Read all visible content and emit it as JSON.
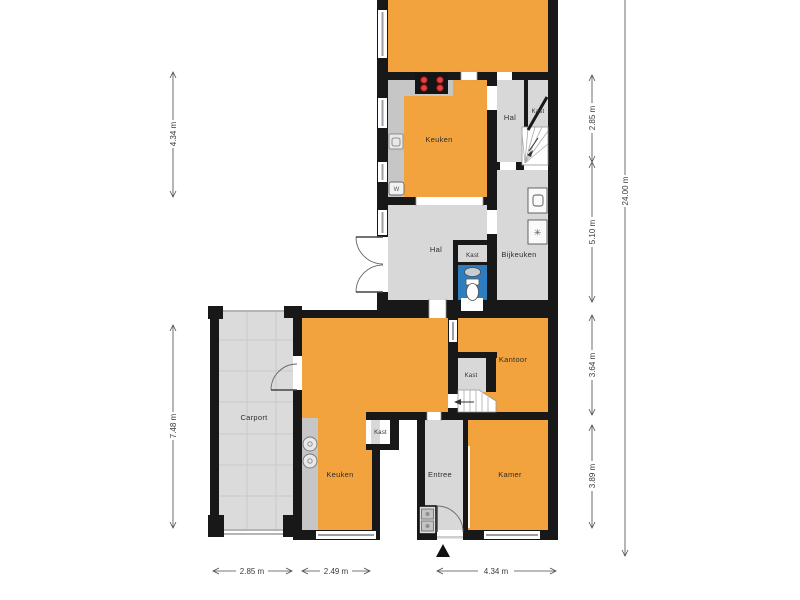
{
  "plan": {
    "type": "floorplan",
    "colors": {
      "room_orange": "#F2A33E",
      "room_gray": "#D8D8D8",
      "counter_gray": "#C6C6C6",
      "carport_gray": "#DBDBDB",
      "wall_black": "#181818",
      "toilet_blue": "#2E7DBF"
    },
    "rooms": {
      "keuken_top": {
        "label": "Keuken"
      },
      "hal_top": {
        "label": "Hal"
      },
      "kast_top": {
        "label": "Kast"
      },
      "hal_mid": {
        "label": "Hal"
      },
      "kast_mid": {
        "label": "Kast"
      },
      "bijkeuken": {
        "label": "Bijkeuken"
      },
      "carport": {
        "label": "Carport"
      },
      "keuken_bottom": {
        "label": "Keuken"
      },
      "kantoor": {
        "label": "Kantoor"
      },
      "kast_kantoor": {
        "label": "Kast"
      },
      "kast_keuken": {
        "label": "Kast"
      },
      "entree": {
        "label": "Entree"
      },
      "kamer": {
        "label": "Kamer"
      }
    },
    "dimensions": {
      "left": [
        {
          "label": "4.34 m"
        },
        {
          "label": "7.48 m"
        }
      ],
      "right_inner": [
        {
          "label": "2.85 m"
        },
        {
          "label": "5.10 m"
        },
        {
          "label": "3.64 m"
        },
        {
          "label": "3.89 m"
        }
      ],
      "right_outer": {
        "label": "24.00 m"
      },
      "bottom": [
        {
          "label": "2.85 m"
        },
        {
          "label": "2.49 m"
        },
        {
          "label": "4.34 m"
        }
      ]
    },
    "icons": {
      "boiler": "W",
      "dryer_fan": "✳",
      "north_arrow": "▲"
    }
  }
}
